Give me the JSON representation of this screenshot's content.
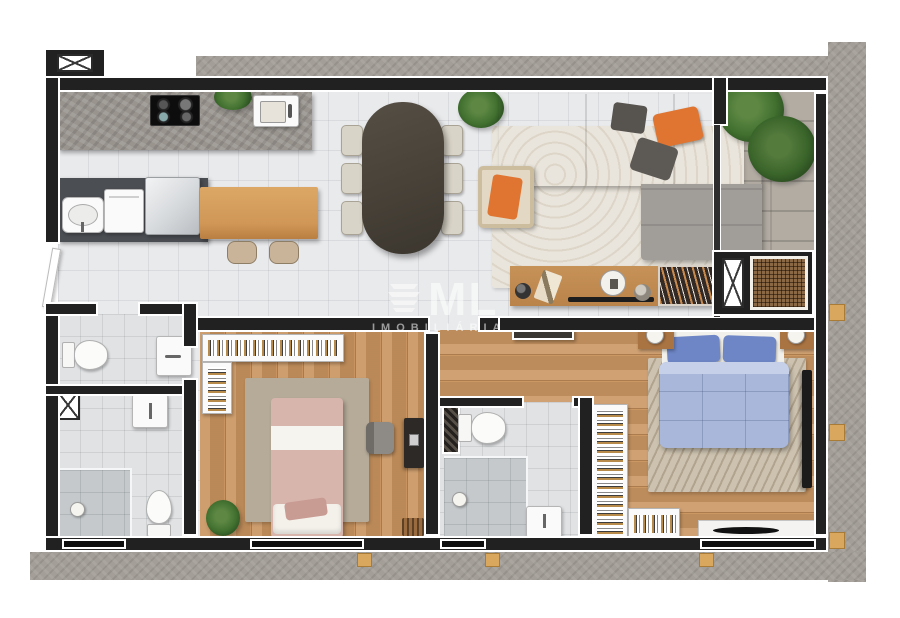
{
  "watermark": {
    "logo_icon": "building-icon",
    "brand": "ML",
    "subtitle": "IMOBILIÁRIA"
  },
  "diagram": {
    "type": "residential-apartment-floor-plan-3d-top-view",
    "rooms": [
      {
        "name": "kitchen-laundry",
        "items": [
          "concrete-counter",
          "cooktop-4-burners",
          "kitchen-sink",
          "plant",
          "laundry-tub",
          "washing-machine",
          "fridge",
          "wood-breakfast-bar",
          "two-stools"
        ]
      },
      {
        "name": "dining-room",
        "items": [
          "dark-oval-table",
          "six-beige-chairs",
          "corner-plant"
        ]
      },
      {
        "name": "living-room",
        "items": [
          "gray-sectional-sofa",
          "orange-pillows",
          "wavy-area-rug",
          "rattan-armchair-orange-cushion",
          "wood-console-sideboard",
          "decor-objects",
          "plants"
        ]
      },
      {
        "name": "balcony-terrace",
        "items": [
          "stone-deck",
          "fern",
          "palm",
          "shaft",
          "vent-grille"
        ]
      },
      {
        "name": "bathroom-upper-left",
        "items": [
          "toilet",
          "vanity-sink"
        ]
      },
      {
        "name": "bathroom-lower-left",
        "items": [
          "sink",
          "walk-in-shower",
          "toilet",
          "shaft"
        ]
      },
      {
        "name": "bedroom-1",
        "items": [
          "single-bed-pink-bedding",
          "open-closet-hanging-clothes",
          "area-rug",
          "desk",
          "office-chair",
          "plant",
          "magazine-rack"
        ]
      },
      {
        "name": "bathroom-middle",
        "items": [
          "toilet",
          "walk-in-shower",
          "sink",
          "hatched-shaft"
        ]
      },
      {
        "name": "bedroom-2",
        "items": [
          "double-bed-blue-bedding",
          "two-nightstands-with-lamps",
          "chevron-rug",
          "open-wardrobe-hanging-clothes",
          "wall-tv",
          "window-bench"
        ]
      }
    ],
    "symbols": [
      "x-crossed-shaft-boxes",
      "hatched-vent-grille",
      "window-openings-in-walls",
      "entry-door-leaf"
    ]
  },
  "palette": {
    "background": "#ffffff",
    "wall": "#212121",
    "wall_outline": "#ffffff",
    "tile_floor": "#e9eaec",
    "wood_floor": "#c8935e",
    "concrete": "#a39e97",
    "counter": "#99948e",
    "sofa_gray": "#a4a09c",
    "accent_orange": "#df7530",
    "duvet_blue": "#a9b7da",
    "pillow_blue": "#6e86c6",
    "bed_pink": "#d8b5ac",
    "living_rug": "#e8e3da",
    "bedroom2_rug": "#c4b8a5",
    "plant_green": "#41702f",
    "bar_wood": "#d59f62",
    "table_dark": "#4a443b"
  }
}
